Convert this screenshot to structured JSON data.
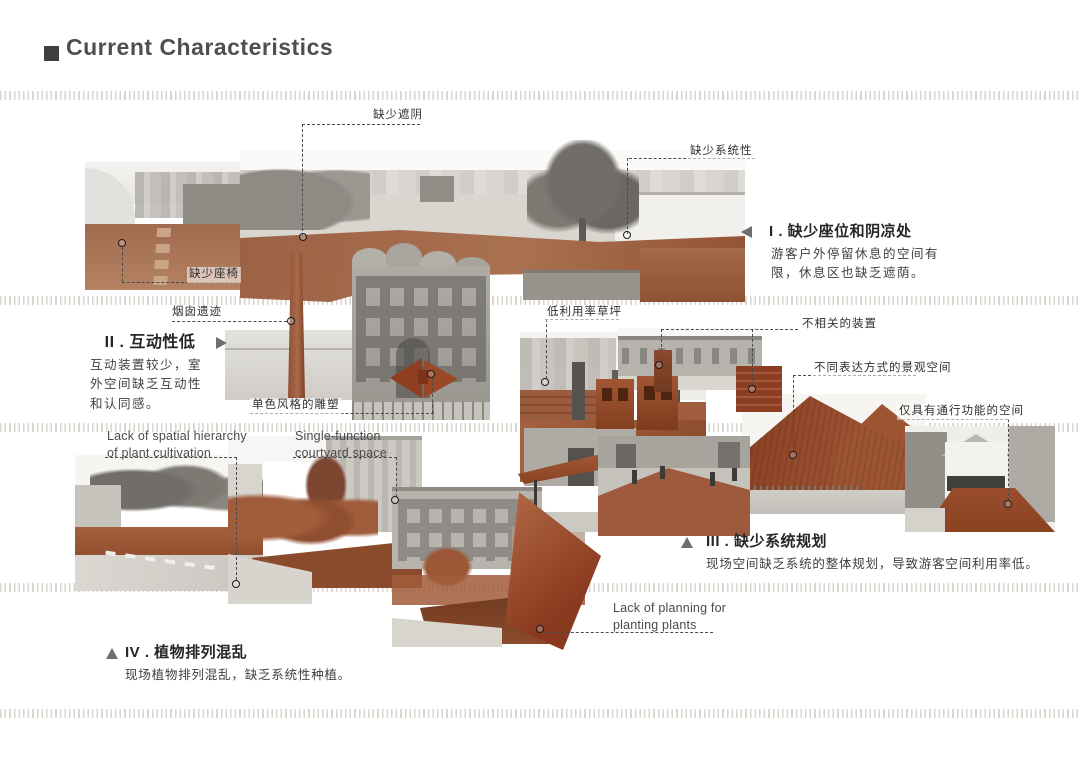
{
  "page": {
    "title": "Current Characteristics"
  },
  "sections": [
    {
      "key": "I",
      "title": "I . 缺少座位和阴凉处",
      "body": "游客户外停留休息的空间有\n限，休息区也缺乏遮荫。",
      "marker": "left-triangle"
    },
    {
      "key": "II",
      "title": "II . 互动性低",
      "body": "互动装置较少，室\n外空间缺乏互动性\n和认同感。",
      "marker": "right-triangle"
    },
    {
      "key": "III",
      "title": "III . 缺少系统规划",
      "body": "现场空间缺乏系统的整体规划，导致游客空间利用率低。",
      "marker": "up-triangle"
    },
    {
      "key": "IV",
      "title": "IV . 植物排列混乱",
      "body": "现场植物排列混乱，缺乏系统性种植。",
      "marker": "up-triangle"
    }
  ],
  "callouts": [
    {
      "text": "缺少遮阴"
    },
    {
      "text": "缺少系统性"
    },
    {
      "text": "缺少座椅"
    },
    {
      "text": "烟囱遗迹"
    },
    {
      "text": "单色风格的雕塑"
    },
    {
      "text": "低利用率草坪"
    },
    {
      "text": "不相关的装置"
    },
    {
      "text": "不同表达方式的景观空间"
    },
    {
      "text": "仅具有通行功能的空间"
    },
    {
      "text": "Lack of spatial hierarchy\nof plant cultivation"
    },
    {
      "text": "Single-function\ncourtyard space"
    },
    {
      "text": "Lack of planning for\nplanting plants"
    }
  ],
  "colors": {
    "collage_red": "#9a5232",
    "photo_gray": "#b3b0aa",
    "text_dark": "#3d3d3d",
    "separator_tick": "#d9d5cf"
  }
}
